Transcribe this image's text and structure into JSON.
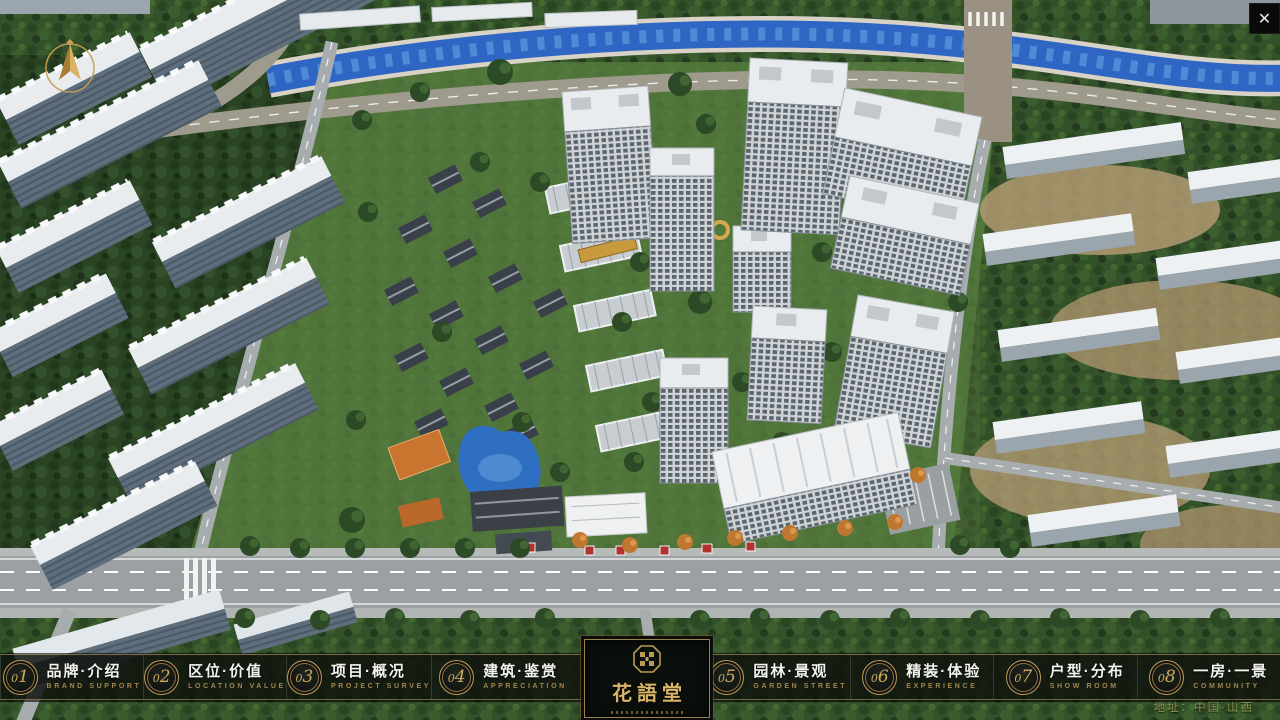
{
  "window": {
    "icons": {
      "close_glyph": "✕"
    }
  },
  "brand": {
    "name": "花語堂"
  },
  "menu": {
    "items": [
      {
        "num": "01",
        "zh": "品牌·介绍",
        "en": "BRAND SUPPORT"
      },
      {
        "num": "02",
        "zh": "区位·价值",
        "en": "LOCATION VALUE"
      },
      {
        "num": "03",
        "zh": "项目·概况",
        "en": "PROJECT SURVEY"
      },
      {
        "num": "04",
        "zh": "建筑·鉴赏",
        "en": "APPRECIATION"
      },
      {
        "num": "05",
        "zh": "园林·景观",
        "en": "GARDEN STREET"
      },
      {
        "num": "06",
        "zh": "精装·体验",
        "en": "EXPERIENCE"
      },
      {
        "num": "07",
        "zh": "户型·分布",
        "en": "SHOW ROOM"
      },
      {
        "num": "08",
        "zh": "一房·一景",
        "en": "COMMUNITY"
      }
    ]
  },
  "footer": {
    "address": "地址：中国·山西"
  },
  "colors": {
    "gold": "#c9a85c",
    "bar_background": "rgba(15,19,14,0.85)",
    "river_blue": "#2f66c4",
    "lawn_green": "#5a8140"
  }
}
